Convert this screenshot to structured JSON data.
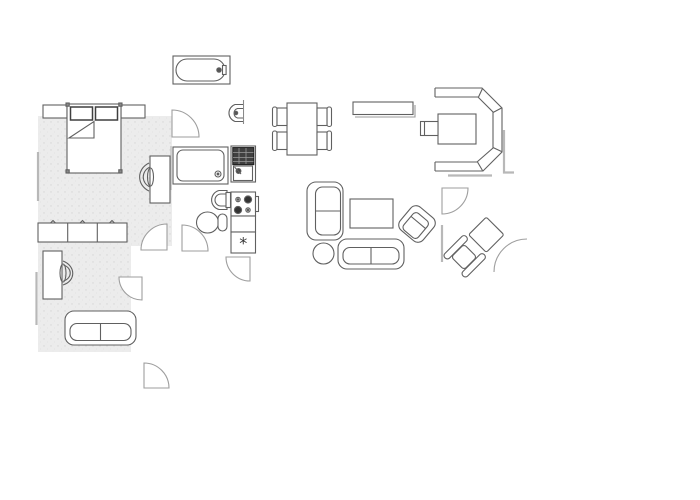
{
  "title": "apartment-floor-plan",
  "symbols": {
    "freezer": "*"
  },
  "colors": {
    "background": "#ffffff",
    "line": "#606060",
    "soft_line": "#8a8a8a",
    "wall": "#b8b8b8",
    "door": "#9e9e9e",
    "dark_appliance": "#404040",
    "floor_fill": "#ececec",
    "floor_speckle": "#d6d6d6"
  },
  "rooms": {
    "bedroom": {
      "label": "bedroom"
    },
    "bathroom": {
      "label": "bathroom"
    },
    "kitchen": {
      "label": "kitchen"
    },
    "living_room": {
      "label": "living room"
    },
    "study": {
      "label": "study room"
    },
    "hallway": {
      "label": "hallway"
    }
  },
  "furniture": {
    "bed": {
      "label": "double bed with two pillows"
    },
    "nightstand_left": {
      "label": "left nightstand"
    },
    "nightstand_right": {
      "label": "right nightstand"
    },
    "bedroom_table": {
      "label": "bedroom table"
    },
    "bedroom_chair": {
      "label": "bedroom chair"
    },
    "bathtub": {
      "label": "bathtub"
    },
    "wall_sink": {
      "label": "wall-mounted sink"
    },
    "shower": {
      "label": "shower tray"
    },
    "washbasin": {
      "label": "washbasin"
    },
    "toilet": {
      "label": "toilet"
    },
    "sink_unit": {
      "label": "kitchen sink unit with drainer"
    },
    "stove": {
      "label": "four-burner stove"
    },
    "counter": {
      "label": "kitchen counter"
    },
    "fridge": {
      "label": "fridge freezer"
    },
    "dining_table": {
      "label": "dining table"
    },
    "dining_chair": {
      "label": "dining chair"
    },
    "sideboard": {
      "label": "sideboard shelf"
    },
    "sofa_small": {
      "label": "two-seat sofa vertical"
    },
    "coffee_table": {
      "label": "coffee table"
    },
    "armchair": {
      "label": "rotated armchair"
    },
    "sofa_large": {
      "label": "two-seat sofa horizontal"
    },
    "side_table": {
      "label": "round side table"
    },
    "lounge_chair": {
      "label": "lounge chair with ottoman"
    },
    "corner_bench": {
      "label": "corner bench seating"
    },
    "bench_table": {
      "label": "corner bench table"
    },
    "bench_chair": {
      "label": "bench chair"
    },
    "wardrobe": {
      "label": "three-door low cabinet"
    },
    "desk": {
      "label": "desk"
    },
    "desk_chair": {
      "label": "desk chair"
    },
    "study_sofa": {
      "label": "study sofa"
    },
    "door": {
      "label": "door swing"
    },
    "wall": {
      "label": "wall segment"
    }
  }
}
